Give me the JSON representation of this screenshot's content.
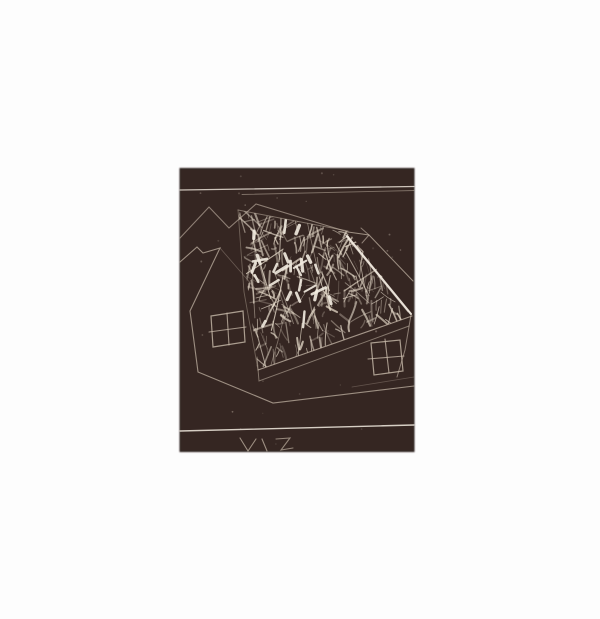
{
  "page": {
    "width": 600,
    "height": 619,
    "paper_color": "#fdfdfd"
  },
  "artwork": {
    "description": "Dark intaglio print of overlapping house outlines; large tilted scribbled roof, two four-pane windows, rooflines and rule lines scratched in white on a dark brown plate",
    "plate": {
      "x": 180,
      "y": 168.5,
      "width": 234,
      "height": 283,
      "color": "#342722",
      "edge_color": "#221913"
    },
    "palette": {
      "paper": "#fdfdfd",
      "plate": "#342722",
      "line_bright": "#f2ebe0",
      "line_soft": "#c9bbab",
      "texture": "#eadfce"
    },
    "lines": [
      {
        "name": "top-rule-1",
        "pts": [
          [
            180,
            190
          ],
          [
            414,
            186.5
          ]
        ],
        "w": 1.3,
        "o": 0.8,
        "bright": true
      },
      {
        "name": "top-rule-2",
        "pts": [
          [
            242,
            194.5
          ],
          [
            414,
            190.5
          ]
        ],
        "w": 0.9,
        "o": 0.5
      },
      {
        "name": "background-roofline-zigzag",
        "pts": [
          [
            180,
            238
          ],
          [
            209,
            207
          ],
          [
            229,
            228
          ],
          [
            256,
            204
          ],
          [
            348,
            232
          ]
        ],
        "w": 1.1,
        "o": 0.6
      },
      {
        "name": "left-house-outline",
        "pts": [
          [
            180,
            262
          ],
          [
            197,
            247
          ],
          [
            203,
            253
          ],
          [
            220,
            248
          ],
          [
            190,
            311
          ],
          [
            198,
            372
          ],
          [
            273,
            403
          ],
          [
            414,
            386
          ]
        ],
        "w": 1.1,
        "o": 0.7
      },
      {
        "name": "left-house-roof-slope",
        "pts": [
          [
            220,
            248
          ],
          [
            259,
            293
          ]
        ],
        "w": 0.8,
        "o": 0.35
      },
      {
        "name": "roof-top-edge",
        "pts": [
          [
            238,
            210
          ],
          [
            348,
            231
          ]
        ],
        "w": 1.0,
        "o": 0.5
      },
      {
        "name": "roof-left-edge",
        "pts": [
          [
            238,
            210
          ],
          [
            244,
            292
          ],
          [
            258,
            370
          ]
        ],
        "w": 0.9,
        "o": 0.4
      },
      {
        "name": "roof-bottom-edge",
        "pts": [
          [
            258,
            370
          ],
          [
            412,
            316
          ]
        ],
        "w": 1.1,
        "o": 0.75
      },
      {
        "name": "roof-eave-highlight",
        "pts": [
          [
            347,
            236
          ],
          [
            411,
            314
          ]
        ],
        "w": 2.1,
        "o": 0.95,
        "bright": true
      },
      {
        "name": "roof-eave-highlight-2",
        "pts": [
          [
            344,
            234
          ],
          [
            408,
            312
          ]
        ],
        "w": 0.8,
        "o": 0.55,
        "bright": true
      },
      {
        "name": "fascia-line",
        "pts": [
          [
            257,
            357
          ],
          [
            259,
            381
          ],
          [
            409,
            326
          ]
        ],
        "w": 0.95,
        "o": 0.55
      },
      {
        "name": "gable-outline",
        "pts": [
          [
            348,
            232
          ],
          [
            369,
            235
          ],
          [
            413,
            281
          ]
        ],
        "w": 1.0,
        "o": 0.7
      },
      {
        "name": "gable-apex-mark",
        "pts": [
          [
            361,
            228
          ],
          [
            369,
            235
          ],
          [
            362,
            243
          ]
        ],
        "w": 1.0,
        "o": 0.6
      },
      {
        "name": "right-wall-edge",
        "pts": [
          [
            411,
            315
          ],
          [
            405,
            350
          ],
          [
            397,
            377
          ]
        ],
        "w": 1.0,
        "o": 0.6
      },
      {
        "name": "wall-base-line",
        "pts": [
          [
            352,
            387
          ],
          [
            414,
            377
          ]
        ],
        "w": 0.8,
        "o": 0.3
      },
      {
        "name": "bottom-rule",
        "pts": [
          [
            180,
            431
          ],
          [
            414,
            425
          ]
        ],
        "w": 1.4,
        "o": 0.85,
        "bright": true
      },
      {
        "name": "plate-mark-v",
        "pts": [
          [
            240,
            438
          ],
          [
            248,
            451
          ],
          [
            256,
            439
          ]
        ],
        "w": 1.1,
        "o": 0.7
      },
      {
        "name": "plate-mark-stroke",
        "pts": [
          [
            262,
            439
          ],
          [
            267,
            451
          ]
        ],
        "w": 1.1,
        "o": 0.7
      },
      {
        "name": "plate-mark-z",
        "pts": [
          [
            276,
            439
          ],
          [
            290,
            438
          ],
          [
            281,
            450
          ],
          [
            293,
            448
          ]
        ],
        "w": 1.1,
        "o": 0.65
      },
      {
        "name": "left-window-frame",
        "pts": [
          [
            211,
            316
          ],
          [
            243,
            311
          ],
          [
            245,
            342
          ],
          [
            213,
            347
          ]
        ],
        "closed": true,
        "w": 1.2,
        "o": 0.8
      },
      {
        "name": "left-window-mullion-v",
        "pts": [
          [
            227,
            313
          ],
          [
            229,
            345
          ]
        ],
        "w": 1.1,
        "o": 0.75
      },
      {
        "name": "left-window-mullion-h",
        "pts": [
          [
            209,
            332
          ],
          [
            246,
            327
          ]
        ],
        "w": 1.1,
        "o": 0.75
      },
      {
        "name": "right-window-frame",
        "pts": [
          [
            371,
            343
          ],
          [
            400,
            340
          ],
          [
            403,
            371
          ],
          [
            374,
            375
          ]
        ],
        "closed": true,
        "w": 1.2,
        "o": 0.8
      },
      {
        "name": "right-window-mullion-v",
        "pts": [
          [
            385,
            339
          ],
          [
            389,
            373
          ]
        ],
        "w": 1.1,
        "o": 0.75
      },
      {
        "name": "right-window-mullion-h",
        "pts": [
          [
            368,
            359
          ],
          [
            404,
            356
          ]
        ],
        "w": 1.1,
        "o": 0.75
      }
    ],
    "roof_texture": {
      "polygon": [
        [
          238,
          210
        ],
        [
          348,
          231
        ],
        [
          412,
          316
        ],
        [
          258,
          370
        ]
      ],
      "seed": 11,
      "strokes": 300,
      "bright_strokes": 26,
      "long_streaks": 16
    },
    "specks": {
      "seed": 5,
      "count": 28,
      "region": [
        183,
        171,
        411,
        448
      ]
    }
  }
}
